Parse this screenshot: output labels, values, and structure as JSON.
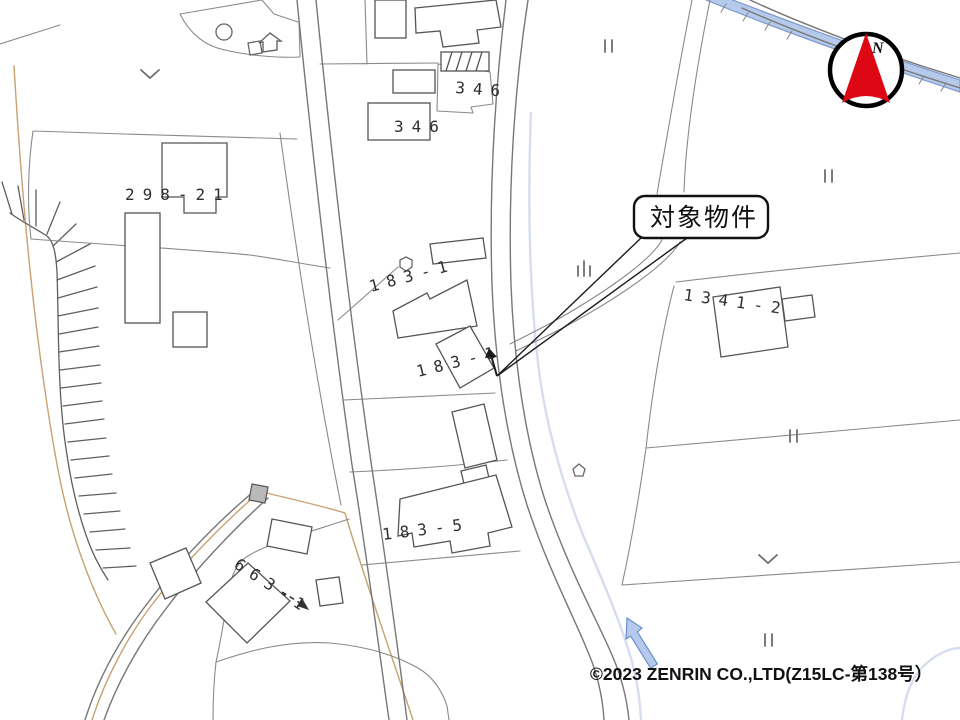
{
  "map": {
    "callout": {
      "label": "対象物件"
    },
    "compass": {
      "label": "N"
    },
    "copyright": "©2023 ZENRIN CO.,LTD(Z15LC-第138号）",
    "parcel_labels": [
      {
        "name": "parcel-346-north",
        "text": "346"
      },
      {
        "name": "parcel-346-south",
        "text": "346"
      },
      {
        "name": "parcel-298-21",
        "text": "298-21"
      },
      {
        "name": "parcel-183-1-north",
        "text": "183-1"
      },
      {
        "name": "parcel-183-1-south",
        "text": "183-1"
      },
      {
        "name": "parcel-183-5",
        "text": "183-5"
      },
      {
        "name": "parcel-663-1",
        "text": "663-1"
      },
      {
        "name": "parcel-1341-2",
        "text": "1341-2"
      }
    ],
    "colors": {
      "water_fill": "#b5c9ea",
      "water_edge": "#7d9ad0",
      "boundary_tan": "#c9a173",
      "compass_red": "#dd0714",
      "building_gray": "#b9b9b9"
    }
  }
}
